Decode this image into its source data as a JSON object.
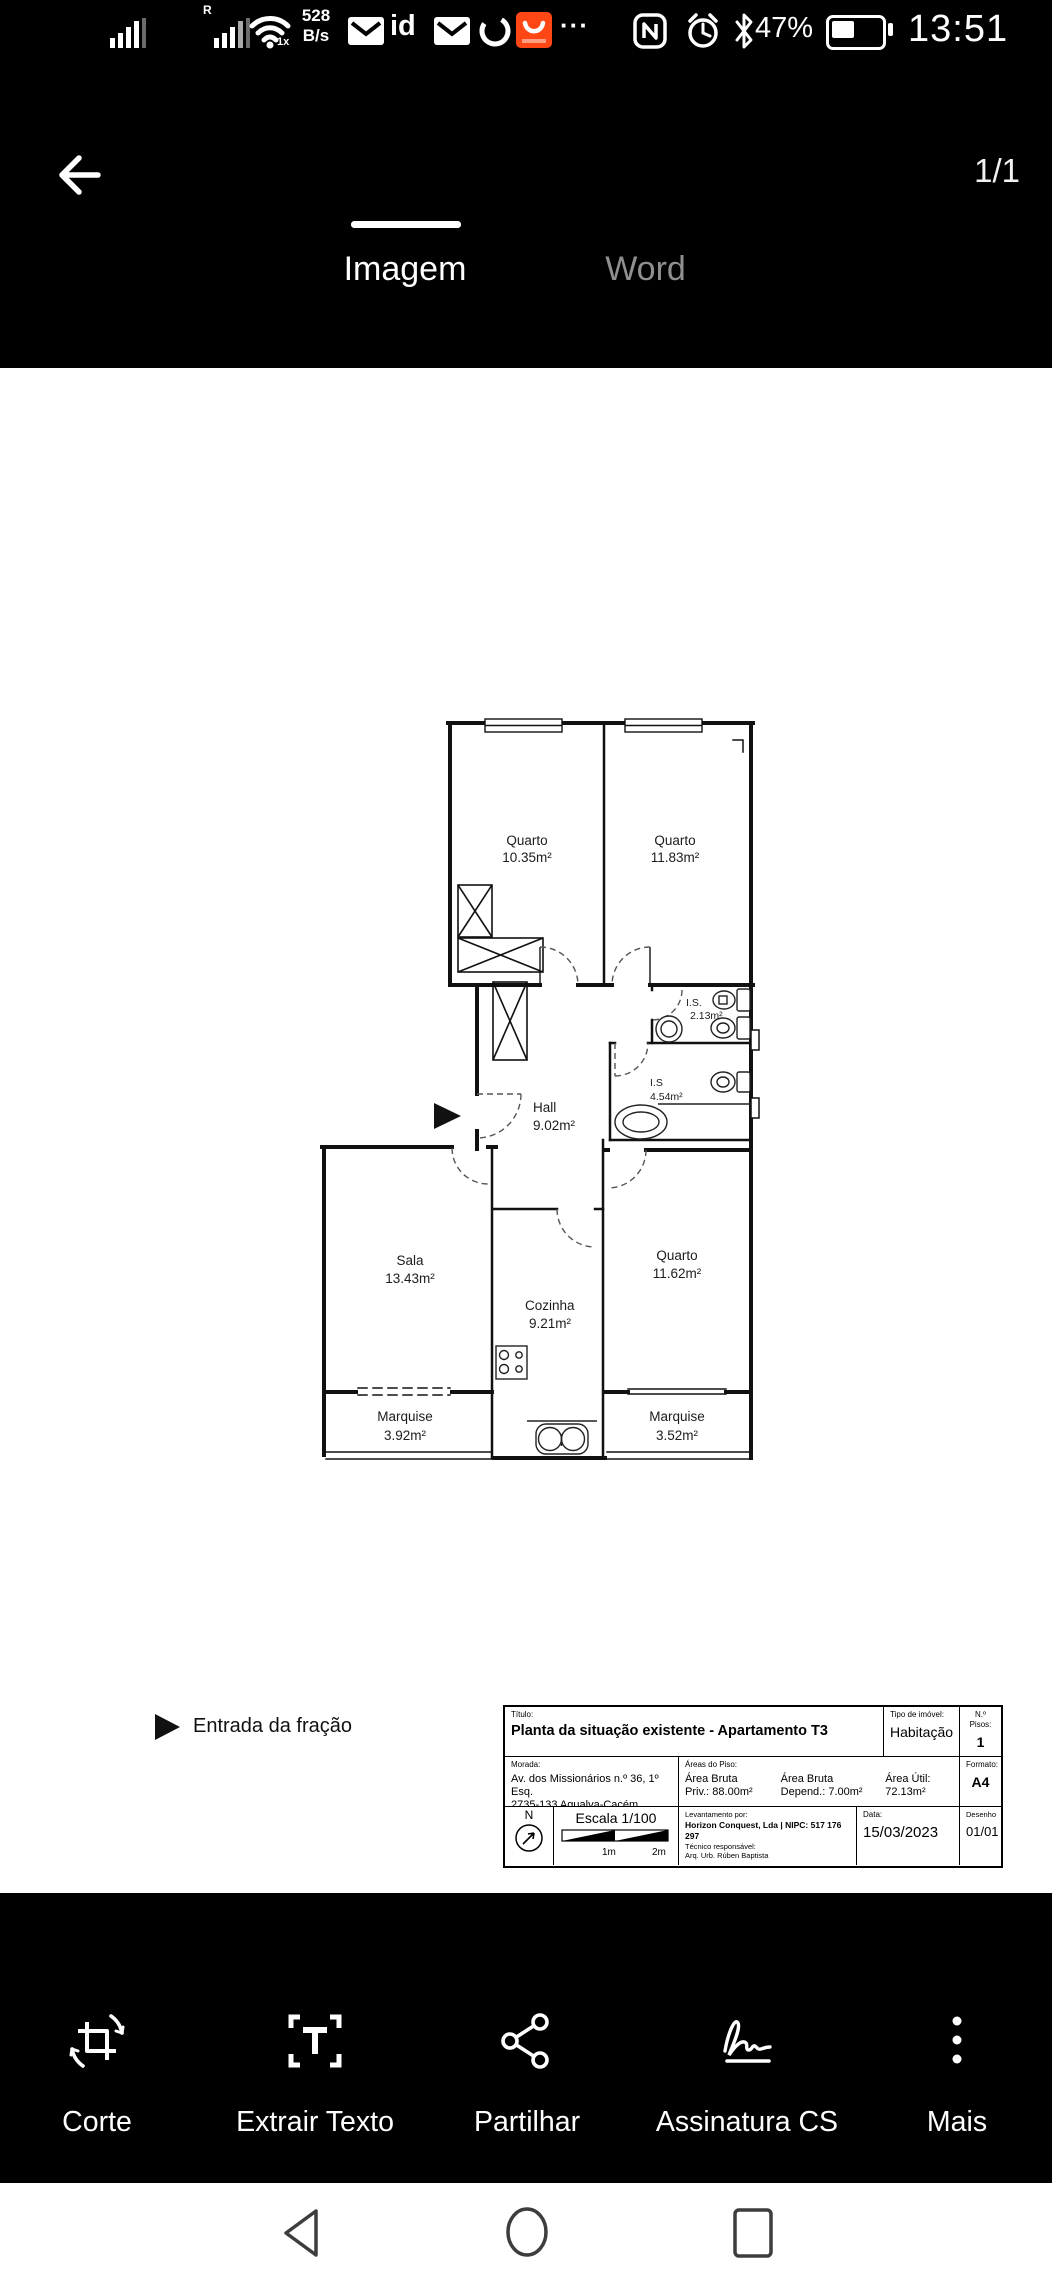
{
  "status_bar": {
    "network_speed_top": "528",
    "network_speed_bottom": "B/s",
    "sim2_badge": "R",
    "wifi_badge": "1x",
    "id_icon_label": "id",
    "more_dots": "···",
    "battery_percent": "47%",
    "time": "13:51",
    "accent_orange": "#ff4716"
  },
  "header": {
    "tabs": [
      {
        "label": "Imagem",
        "active": true
      },
      {
        "label": "Word",
        "active": false
      }
    ],
    "page_indicator": "1/1"
  },
  "plan": {
    "rooms": [
      {
        "name": "Quarto",
        "area": "10.35m²"
      },
      {
        "name": "Quarto",
        "area": "11.83m²"
      },
      {
        "name": "I.S.",
        "area": "2.13m²"
      },
      {
        "name": "I.S",
        "area": "4.54m²"
      },
      {
        "name": "Hall",
        "area": "9.02m²"
      },
      {
        "name": "Sala",
        "area": "13.43m²"
      },
      {
        "name": "Cozinha",
        "area": "9.21m²"
      },
      {
        "name": "Quarto",
        "area": "11.62m²"
      },
      {
        "name": "Marquise",
        "area": "3.92m²"
      },
      {
        "name": "Marquise",
        "area": "3.52m²"
      }
    ],
    "legend": {
      "entry_label": "Entrada da fração"
    }
  },
  "title_block": {
    "titulo_label": "Título:",
    "titulo": "Planta da situação existente - Apartamento T3",
    "tipo_label": "Tipo de imóvel:",
    "tipo": "Habitação",
    "pisos_label": "N.º Pisos:",
    "pisos": "1",
    "morada_label": "Morada:",
    "morada_line1": "Av. dos Missionários n.º 36, 1º Esq.",
    "morada_line2": "2735-133 Agualva-Cacém, Sintra",
    "areas_label": "Áreas do Piso:",
    "area_bruta_priv_l1": "Área Bruta",
    "area_bruta_priv_l2": "Priv.: 88.00m²",
    "area_bruta_dep_l1": "Área Bruta",
    "area_bruta_dep_l2": "Depend.: 7.00m²",
    "area_util_l1": "Área Útil:",
    "area_util_l2": "72.13m²",
    "formato_label": "Formato:",
    "formato": "A4",
    "north_label": "N",
    "escala": "Escala 1/100",
    "scale_tick_1": "1m",
    "scale_tick_2": "2m",
    "levantamento_label": "Levantamento por:",
    "levantamento": "Horizon Conquest, Lda | NIPC: 517 176 297",
    "tecnico_label": "Técnico responsável:",
    "tecnico": "Arq. Urb. Rúben Baptista",
    "data_label": "Data:",
    "data": "15/03/2023",
    "desenho_label": "Desenho",
    "desenho": "01/01"
  },
  "toolbar": {
    "items": [
      {
        "label": "Corte"
      },
      {
        "label": "Extrair Texto"
      },
      {
        "label": "Partilhar"
      },
      {
        "label": "Assinatura CS"
      },
      {
        "label": "Mais"
      }
    ]
  }
}
